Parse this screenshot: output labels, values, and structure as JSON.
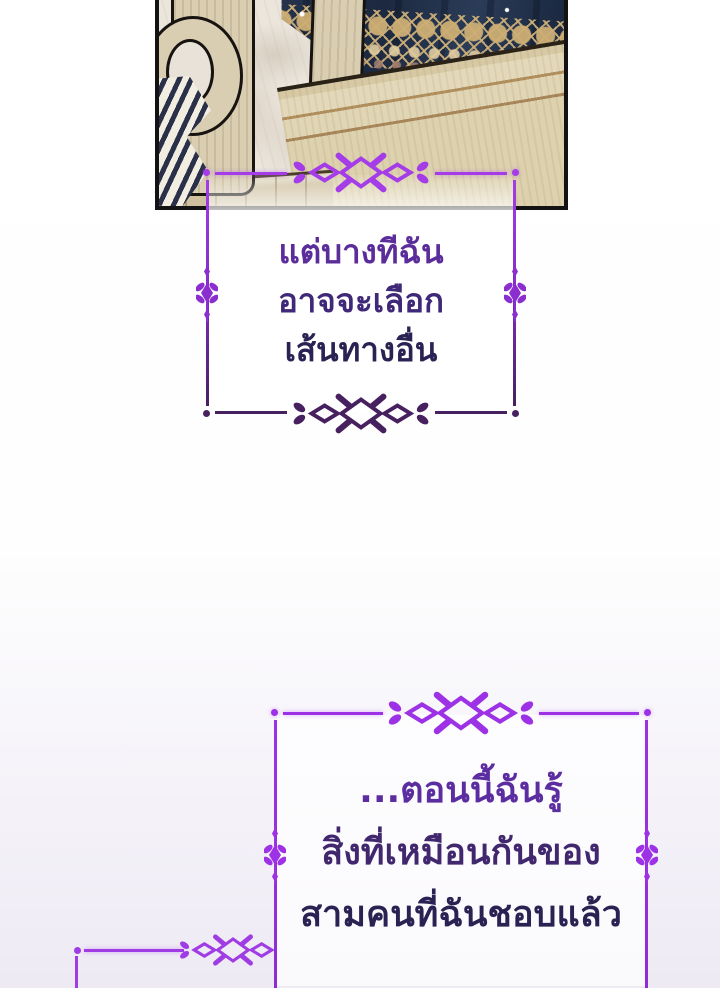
{
  "page": {
    "background_top": "#ffffff",
    "background_bottom": "#edeaf3"
  },
  "panel": {
    "border_color": "#131313",
    "colors": {
      "curtain_navy": "#22314d",
      "lace_gold": "#c9a96e",
      "lace_mauve": "#96756e",
      "headboard_wood": "#ddd2ae",
      "headboard_trim": "#a8875a",
      "post_wood": "#d9cdb2",
      "marble": "#ebe5dc",
      "zebra_stripe": "#2a3048",
      "floor_wood": "#cfc1a0",
      "sparkle": "#ffffff"
    }
  },
  "icons": {
    "frame_ornament": "diamond-cross-flourish",
    "side_flourish": "vertical-diamond-flourish",
    "corner_dot": "dot"
  },
  "dialogs": [
    {
      "lines": [
        "แต่บางทีฉัน",
        "อาจจะเลือก",
        "เส้นทางอื่น"
      ],
      "frame_top_color": "#a43ce8",
      "frame_bottom_color": "#47205f",
      "text_top_color": "#5b2d9b",
      "text_bottom_color": "#2b2254"
    },
    {
      "lines": [
        "...ตอนนี้ฉันรู้",
        "สิ่งที่เหมือนกันของ",
        "สามคนที่ฉันชอบแล้ว"
      ],
      "frame_top_color": "#9c31e6",
      "frame_bottom_color": "#9c31e6",
      "text_top_color": "#5c2da0",
      "text_bottom_color": "#2a2252"
    }
  ],
  "partial_frame": {
    "color": "#a03ce4"
  }
}
